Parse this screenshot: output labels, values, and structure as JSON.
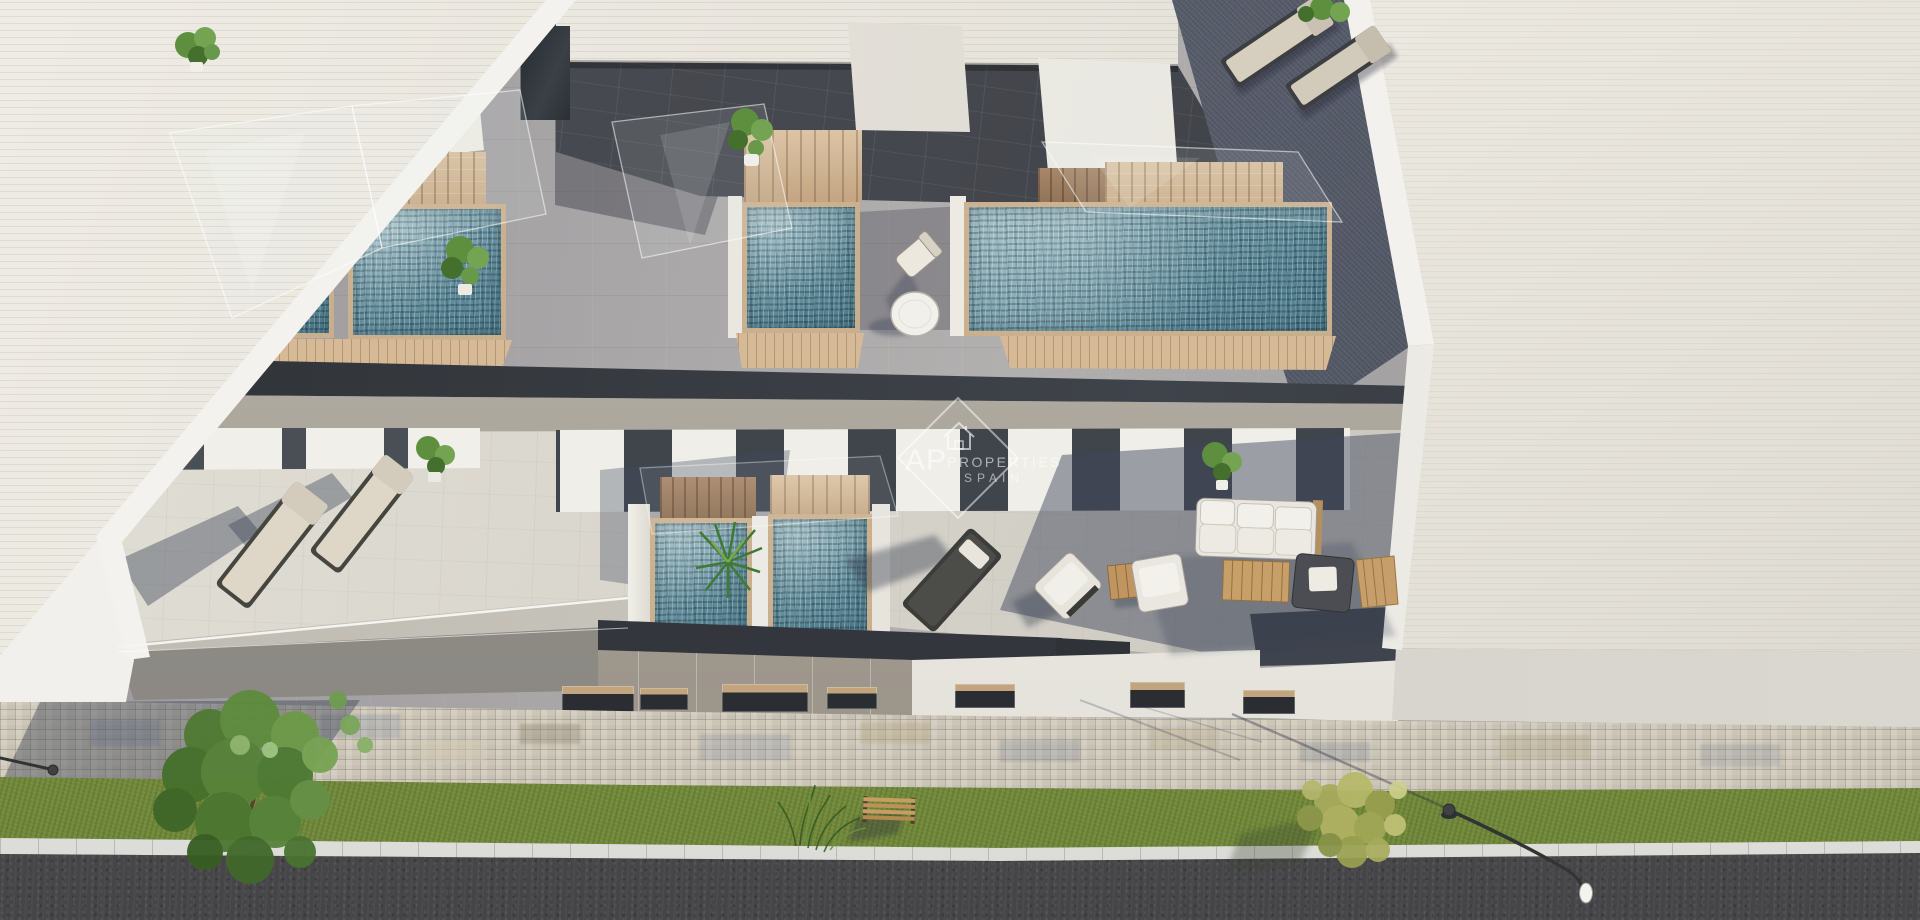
{
  "meta": {
    "image_type": "architectural-3d-render",
    "view": "aerial-top-down",
    "subject": "new-build townhouses with rooftop solarium plunge pools, terraces and street"
  },
  "watermark": {
    "initials": "AP",
    "name": "PROPERTIES",
    "country": "SPAIN",
    "icon": "house-icon"
  },
  "scene": {
    "rooftop_pools": 4,
    "ground_floor_pools": 2,
    "sun_loungers": 4,
    "lounge_chairs": 3,
    "sofas": 1,
    "armchairs": 2,
    "coffee_tables": 1,
    "side_tables": 1,
    "round_tables": 1,
    "benches": 1,
    "street_lamps": 2,
    "street_trees": 2,
    "potted_plants": 7
  },
  "palette": {
    "roof_terrace": "#a6a4a5",
    "pool_water": "#6f96a3",
    "pool_wood": "#cdb190",
    "slab_dark": "#34383d",
    "slab_soffit": "#aba79d",
    "lower_terrace": "#d8d5cc",
    "facade_panels": "#a29c92",
    "facade_charcoal": "#33363b",
    "neighbor_roof_left": "#e8e5de",
    "neighbor_roof_right": "#ebe8e0",
    "slate_terrace": "#565b69",
    "sidewalk_cobble": "#cfc8b9",
    "grass": "#7c9440",
    "road": "#4a4a4c",
    "curb": "#e9e9e7",
    "tree_green": "#5d8f3f",
    "tree_yellow": "#b0b264",
    "cushion": "#d9d2c2",
    "sofa_white": "#e9e7e2",
    "table_wood": "#c9a26d",
    "watermark_white": "#ffffff"
  }
}
